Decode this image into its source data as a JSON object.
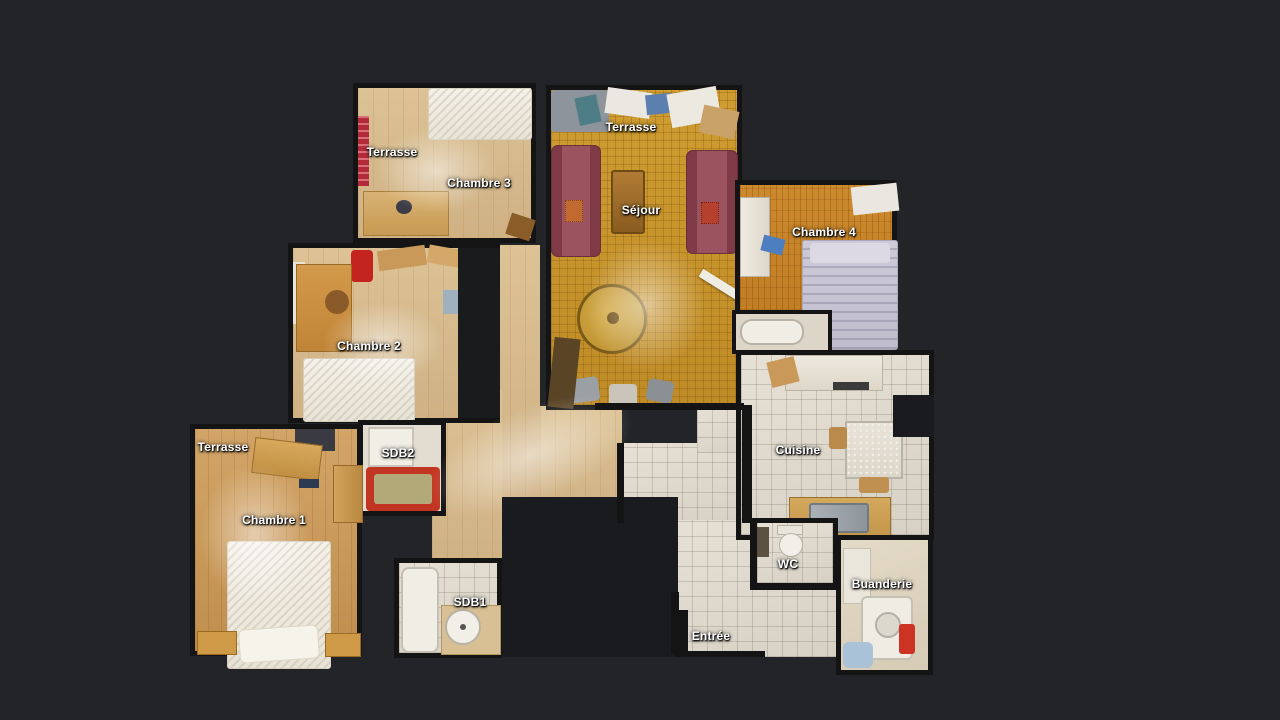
{
  "scene": {
    "description": "Top-down 3D dollhouse floor plan of an apartment",
    "background_color": "#232427"
  },
  "palette": {
    "wall": "#141414",
    "wood_pale": "#d5ba8d",
    "wood_gold": "#c8962e",
    "wood_orange": "#c5822a",
    "wood_mid": "#c79a5e",
    "tile": "#e2dcd0",
    "sofa_red": "#9b5360",
    "bathtub_red": "#c23522",
    "label_text": "#ffffff"
  },
  "rooms": [
    {
      "id": "terrasse-chambre3",
      "label": "Terrasse"
    },
    {
      "id": "chambre3",
      "label": "Chambre 3"
    },
    {
      "id": "terrasse-sejour",
      "label": "Terrasse"
    },
    {
      "id": "sejour",
      "label": "Séjour"
    },
    {
      "id": "chambre4",
      "label": "Chambre 4"
    },
    {
      "id": "chambre2",
      "label": "Chambre 2"
    },
    {
      "id": "terrasse-chambre1",
      "label": "Terrasse"
    },
    {
      "id": "sdb2",
      "label": "SDB2"
    },
    {
      "id": "chambre1",
      "label": "Chambre 1"
    },
    {
      "id": "cuisine",
      "label": "Cuisine"
    },
    {
      "id": "wc",
      "label": "WC"
    },
    {
      "id": "buanderie",
      "label": "Buanderie"
    },
    {
      "id": "sdb1",
      "label": "SDB1"
    },
    {
      "id": "entree",
      "label": "Entrée"
    }
  ]
}
